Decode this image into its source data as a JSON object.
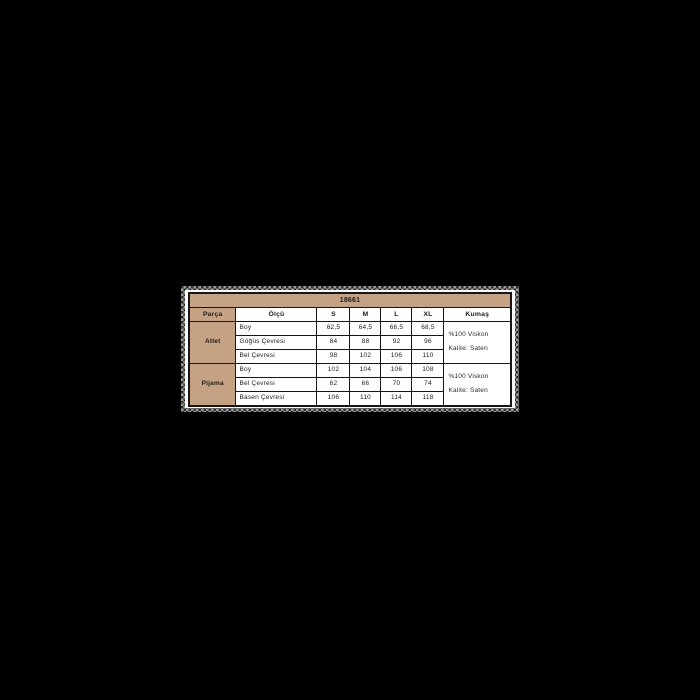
{
  "colors": {
    "page_bg": "#000000",
    "card_bg": "#fbfbfb",
    "accent_tan": "#c6a284",
    "table_border": "#161616",
    "text": "#1c1c1c"
  },
  "chart_data": {
    "type": "table",
    "title": "18661",
    "columns": [
      "Parça",
      "Ölçü",
      "S",
      "M",
      "L",
      "XL",
      "Kumaş"
    ],
    "sections": [
      {
        "part": "Atlet",
        "rows": [
          {
            "measure": "Boy",
            "values": [
              "62,5",
              "64,5",
              "66,5",
              "68,5"
            ]
          },
          {
            "measure": "Göğüs Çevresi",
            "values": [
              "84",
              "88",
              "92",
              "96"
            ]
          },
          {
            "measure": "Bel Çevresi",
            "values": [
              "98",
              "102",
              "106",
              "110"
            ]
          }
        ],
        "fabric_lines": [
          "%100 Viskon",
          "Kalite: Saten"
        ]
      },
      {
        "part": "Pijama",
        "rows": [
          {
            "measure": "Boy",
            "values": [
              "102",
              "104",
              "106",
              "108"
            ]
          },
          {
            "measure": "Bel Çevresi",
            "values": [
              "62",
              "66",
              "70",
              "74"
            ]
          },
          {
            "measure": "Basen Çevresi",
            "values": [
              "106",
              "110",
              "114",
              "118"
            ]
          }
        ],
        "fabric_lines": [
          "%100 Viskon",
          "Kalite: Saten"
        ]
      }
    ]
  }
}
